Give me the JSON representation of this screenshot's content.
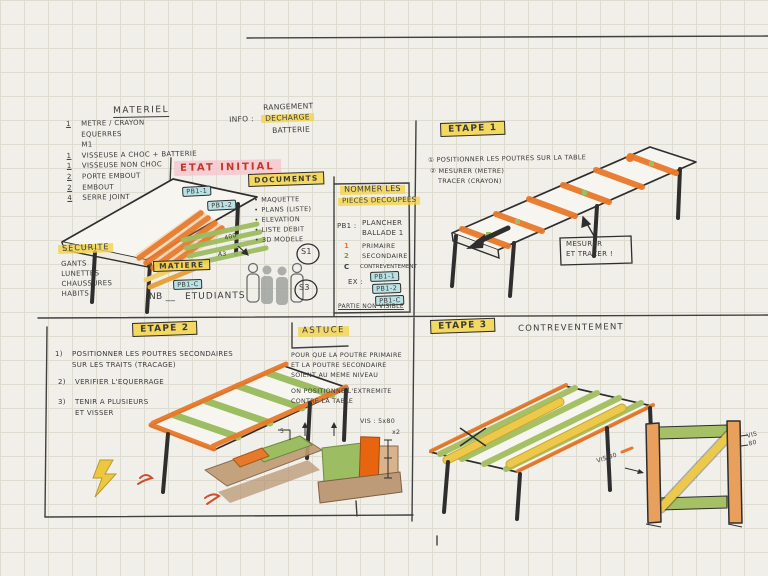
{
  "colors": {
    "paper": "#f1efe9",
    "ink": "#2e2e2e",
    "orange": "#e8792a",
    "orange_bright": "#e8650f",
    "green": "#9dbd62",
    "yellow_hl": "#f3d34a",
    "yellow_wood": "#ecc94b",
    "cyan": "#b9e2e4",
    "pink": "#f5c6cd",
    "red": "#c0392b",
    "brown": "#bd9a78",
    "tan": "#e8a05c"
  },
  "panels": {
    "materiel": {
      "title": "MATERIEL",
      "items": [
        {
          "qty": "1",
          "label": "METRE / CRAYON"
        },
        {
          "qty": "",
          "label": "EQUERRES"
        },
        {
          "qty": "",
          "label": "M1"
        },
        {
          "qty": "1",
          "label": "VISSEUSE A CHOC + BATTERIE"
        },
        {
          "qty": "1",
          "label": "VISSEUSE NON CHOC"
        },
        {
          "qty": "2",
          "label": "PORTE EMBOUT"
        },
        {
          "qty": "2",
          "label": "EMBOUT"
        },
        {
          "qty": "4",
          "label": "SERRE JOINT"
        }
      ]
    },
    "info": {
      "label": "INFO :",
      "line1": "RANGEMENT",
      "line2": "DECHARGE",
      "line3": "BATTERIE"
    },
    "etat_initial": {
      "label": "ETAT INITIAL"
    },
    "documents": {
      "title": "DOCUMENTS",
      "items": [
        "MAQUETTE",
        "PLANS (LISTE)",
        "ELEVATION",
        "LISTE DEBIT",
        "3D MODELE"
      ]
    },
    "securite": {
      "title": "SECURITE",
      "items": [
        "GANTS",
        "LUNETTES",
        "CHAUSSURES",
        "HABITS"
      ]
    },
    "matiere": {
      "title": "MATIERE",
      "tag": "PB1-C"
    },
    "nb_line": {
      "nb": "NB __",
      "rest": "ETUDIANTS"
    },
    "tags": {
      "t1": "PB1-1",
      "t2": "PB1-2"
    },
    "marks": {
      "d400": "400",
      "a3": "A3",
      "s1": "S1",
      "s3": "S3"
    },
    "nommer": {
      "title_l1": "NOMMER LES",
      "title_l2": "PIECES DECOUPEES",
      "key": "PB1 :",
      "key_l1": "PLANCHER",
      "key_l2": "BALLADE 1",
      "rows": [
        {
          "k": "1",
          "v": "PRIMAIRE"
        },
        {
          "k": "2",
          "v": "SECONDAIRE"
        },
        {
          "k": "C",
          "v": "CONTREVENTEMENT"
        }
      ],
      "ex_label": "EX :",
      "ex_tags": [
        "PB1-1",
        "PB1-2",
        "PB1-C"
      ],
      "footer": "PARTIE NON VISIBLE"
    },
    "etape1": {
      "title": "ETAPE 1",
      "line1": "① POSITIONNER LES POUTRES SUR LA TABLE",
      "line2": "② MESURER (METRE)",
      "line3": "TRACER (CRAYON)",
      "note1": "MESURER",
      "note2": "ET TRACER !"
    },
    "etape2": {
      "title": "ETAPE 2",
      "s1n": "1)",
      "s1a": "POSITIONNER LES POUTRES SECONDAIRES",
      "s1b": "SUR LES TRAITS (TRACAGE)",
      "s2n": "2)",
      "s2a": "VERIFIER L'EQUERRAGE",
      "s3n": "3)",
      "s3a": "TENIR A PLUSIEURS",
      "s3b": "ET VISSER"
    },
    "astuce": {
      "title": "ASTUCE",
      "b1": "POUR QUE LA POUTRE PRIMAIRE",
      "b2": "ET LA POUTRE SECONDAIRE",
      "b3": "SOIENT AU MEME NIVEAU",
      "b4": "ON POSITIONNE L'EXTREMITE",
      "b5": "CONTRE LA TABLE",
      "vis": "VIS : 5x80",
      "vis_qty": "x2",
      "dim5": "5"
    },
    "etape3": {
      "title": "ETAPE 3",
      "subtitle": "CONTREVENTEMENT",
      "vis_a": "VIS 80",
      "vis_b": "VIS 80"
    }
  }
}
